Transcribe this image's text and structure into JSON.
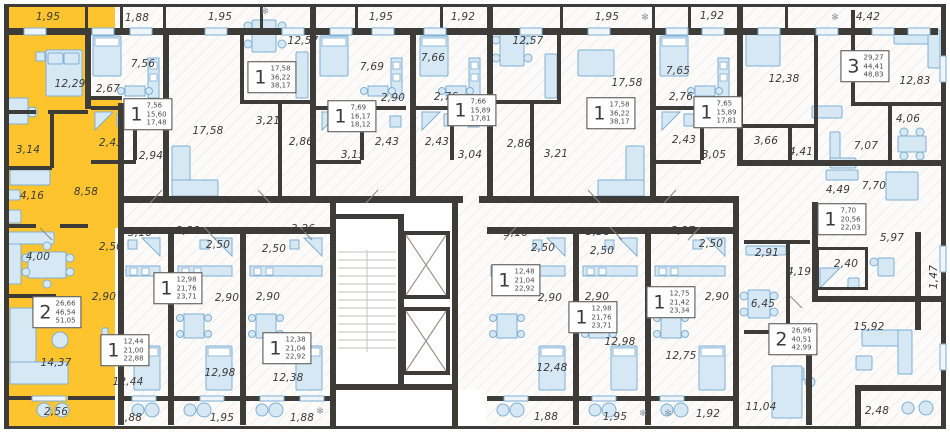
{
  "title": "Residential building floor plan",
  "colors": {
    "highlight": "#fdc42d",
    "wall": "#3e3c39",
    "floor_hatch": "#e8e4df",
    "furniture_fill": "#d7e8f5",
    "furniture_stroke": "#7fafd3",
    "label_text": "#3b3b3b"
  },
  "apartments": [
    {
      "id": "apt-01",
      "type": "2",
      "areas": [
        "26,66",
        "46,54",
        "51,05"
      ],
      "highlighted": true,
      "tag": {
        "x": 57,
        "y": 312
      },
      "rooms": [
        {
          "v": "1,95",
          "x": 48,
          "y": 17
        },
        {
          "v": "12,29",
          "x": 70,
          "y": 84
        },
        {
          "v": "3,14",
          "x": 28,
          "y": 150
        },
        {
          "v": "4,16",
          "x": 32,
          "y": 196
        },
        {
          "v": "8,58",
          "x": 86,
          "y": 192
        },
        {
          "v": "4,00",
          "x": 38,
          "y": 257
        },
        {
          "v": "14,37",
          "x": 56,
          "y": 363
        },
        {
          "v": "2,56",
          "x": 56,
          "y": 412
        }
      ]
    },
    {
      "id": "apt-02",
      "type": "1",
      "areas": [
        "7,56",
        "15,60",
        "17,48"
      ],
      "highlighted": false,
      "tag": {
        "x": 148,
        "y": 114
      },
      "rooms": [
        {
          "v": "1,88",
          "x": 137,
          "y": 18
        },
        {
          "v": "7,56",
          "x": 143,
          "y": 64
        },
        {
          "v": "2,67",
          "x": 108,
          "y": 89
        },
        {
          "v": "2,43",
          "x": 111,
          "y": 143
        },
        {
          "v": "2,94",
          "x": 151,
          "y": 156
        }
      ]
    },
    {
      "id": "apt-03",
      "type": "1",
      "areas": [
        "17,58",
        "36,22",
        "38,17"
      ],
      "highlighted": false,
      "tag": {
        "x": 272,
        "y": 77
      },
      "rooms": [
        {
          "v": "1,95",
          "x": 220,
          "y": 17
        },
        {
          "v": "12,57",
          "x": 303,
          "y": 41
        },
        {
          "v": "17,58",
          "x": 208,
          "y": 131
        },
        {
          "v": "3,21",
          "x": 268,
          "y": 121
        },
        {
          "v": "2,86",
          "x": 301,
          "y": 142
        }
      ]
    },
    {
      "id": "apt-04",
      "type": "1",
      "areas": [
        "7,69",
        "16,17",
        "18,12"
      ],
      "highlighted": false,
      "tag": {
        "x": 352,
        "y": 116
      },
      "rooms": [
        {
          "v": "1,95",
          "x": 381,
          "y": 17
        },
        {
          "v": "7,69",
          "x": 372,
          "y": 67
        },
        {
          "v": "2,90",
          "x": 393,
          "y": 98
        },
        {
          "v": "2,43",
          "x": 387,
          "y": 142
        },
        {
          "v": "3,15",
          "x": 353,
          "y": 155
        }
      ]
    },
    {
      "id": "apt-05",
      "type": "1",
      "areas": [
        "7,66",
        "15,89",
        "17,81"
      ],
      "highlighted": false,
      "tag": {
        "x": 472,
        "y": 110
      },
      "rooms": [
        {
          "v": "1,92",
          "x": 463,
          "y": 17
        },
        {
          "v": "7,66",
          "x": 433,
          "y": 58
        },
        {
          "v": "2,76",
          "x": 446,
          "y": 97
        },
        {
          "v": "2,43",
          "x": 437,
          "y": 142
        },
        {
          "v": "3,04",
          "x": 470,
          "y": 155
        }
      ]
    },
    {
      "id": "apt-06",
      "type": "1",
      "areas": [
        "17,58",
        "36,22",
        "38,17"
      ],
      "highlighted": false,
      "tag": {
        "x": 611,
        "y": 113
      },
      "rooms": [
        {
          "v": "1,95",
          "x": 607,
          "y": 17
        },
        {
          "v": "12,57",
          "x": 528,
          "y": 41
        },
        {
          "v": "17,58",
          "x": 627,
          "y": 83
        },
        {
          "v": "2,86",
          "x": 519,
          "y": 144
        },
        {
          "v": "3,21",
          "x": 556,
          "y": 154
        }
      ]
    },
    {
      "id": "apt-07",
      "type": "1",
      "areas": [
        "7,65",
        "15,89",
        "17,81"
      ],
      "highlighted": false,
      "tag": {
        "x": 718,
        "y": 112
      },
      "rooms": [
        {
          "v": "1,92",
          "x": 712,
          "y": 16
        },
        {
          "v": "7,65",
          "x": 678,
          "y": 71
        },
        {
          "v": "2,76",
          "x": 681,
          "y": 97
        },
        {
          "v": "2,43",
          "x": 684,
          "y": 140
        },
        {
          "v": "3,05",
          "x": 714,
          "y": 155
        }
      ]
    },
    {
      "id": "apt-08",
      "type": "3",
      "areas": [
        "29,27",
        "44,41",
        "48,83"
      ],
      "highlighted": false,
      "tag": {
        "x": 865,
        "y": 66
      },
      "rooms": [
        {
          "v": "4,42",
          "x": 868,
          "y": 17
        },
        {
          "v": "12,38",
          "x": 784,
          "y": 79
        },
        {
          "v": "12,83",
          "x": 915,
          "y": 81
        },
        {
          "v": "4,06",
          "x": 908,
          "y": 119
        },
        {
          "v": "7,07",
          "x": 866,
          "y": 146
        },
        {
          "v": "3,66",
          "x": 766,
          "y": 141
        },
        {
          "v": "4,41",
          "x": 801,
          "y": 152
        }
      ]
    },
    {
      "id": "apt-09",
      "type": "1",
      "areas": [
        "7,70",
        "20,56",
        "22,03"
      ],
      "highlighted": false,
      "tag": {
        "x": 842,
        "y": 219
      },
      "rooms": [
        {
          "v": "4,49",
          "x": 838,
          "y": 190
        },
        {
          "v": "7,70",
          "x": 874,
          "y": 186
        },
        {
          "v": "5,97",
          "x": 892,
          "y": 238
        },
        {
          "v": "2,40",
          "x": 846,
          "y": 264
        },
        {
          "v": "1,47",
          "x": 934,
          "y": 277,
          "rot": true
        }
      ]
    },
    {
      "id": "apt-10",
      "type": "2",
      "areas": [
        "26,96",
        "40,51",
        "42,99"
      ],
      "highlighted": false,
      "tag": {
        "x": 793,
        "y": 339
      },
      "rooms": [
        {
          "v": "2,91",
          "x": 767,
          "y": 253
        },
        {
          "v": "4,19",
          "x": 799,
          "y": 272
        },
        {
          "v": "6,45",
          "x": 763,
          "y": 304
        },
        {
          "v": "15,92",
          "x": 869,
          "y": 327
        },
        {
          "v": "11,04",
          "x": 761,
          "y": 407
        },
        {
          "v": "2,48",
          "x": 877,
          "y": 411
        }
      ]
    },
    {
      "id": "apt-11",
      "type": "1",
      "areas": [
        "12,44",
        "21,00",
        "22,88"
      ],
      "highlighted": false,
      "tag": {
        "x": 125,
        "y": 350
      },
      "rooms": [
        {
          "v": "3,16",
          "x": 140,
          "y": 233
        },
        {
          "v": "2,50",
          "x": 111,
          "y": 247
        },
        {
          "v": "2,90",
          "x": 104,
          "y": 297
        },
        {
          "v": "12,44",
          "x": 128,
          "y": 382
        },
        {
          "v": "1,88",
          "x": 130,
          "y": 418
        }
      ]
    },
    {
      "id": "apt-12",
      "type": "1",
      "areas": [
        "12,98",
        "21,76",
        "23,71"
      ],
      "highlighted": false,
      "tag": {
        "x": 178,
        "y": 288
      },
      "rooms": [
        {
          "v": "3,38",
          "x": 188,
          "y": 231
        },
        {
          "v": "2,50",
          "x": 218,
          "y": 245
        },
        {
          "v": "2,90",
          "x": 227,
          "y": 298
        },
        {
          "v": "12,98",
          "x": 220,
          "y": 373
        },
        {
          "v": "1,95",
          "x": 222,
          "y": 418
        }
      ]
    },
    {
      "id": "apt-13",
      "type": "1",
      "areas": [
        "12,38",
        "21,04",
        "22,92"
      ],
      "highlighted": false,
      "tag": {
        "x": 287,
        "y": 348
      },
      "rooms": [
        {
          "v": "3,26",
          "x": 303,
          "y": 229
        },
        {
          "v": "2,50",
          "x": 274,
          "y": 249
        },
        {
          "v": "2,90",
          "x": 268,
          "y": 297
        },
        {
          "v": "12,38",
          "x": 288,
          "y": 378
        },
        {
          "v": "1,88",
          "x": 302,
          "y": 418
        }
      ]
    },
    {
      "id": "apt-14",
      "type": "1",
      "areas": [
        "12,48",
        "21,04",
        "22,92"
      ],
      "highlighted": false,
      "tag": {
        "x": 516,
        "y": 280
      },
      "rooms": [
        {
          "v": "3,16",
          "x": 516,
          "y": 233
        },
        {
          "v": "2,50",
          "x": 543,
          "y": 248
        },
        {
          "v": "2,90",
          "x": 550,
          "y": 298
        },
        {
          "v": "12,48",
          "x": 552,
          "y": 368
        },
        {
          "v": "1,88",
          "x": 546,
          "y": 417
        }
      ]
    },
    {
      "id": "apt-15",
      "type": "1",
      "areas": [
        "12,98",
        "21,76",
        "23,71"
      ],
      "highlighted": false,
      "tag": {
        "x": 593,
        "y": 317
      },
      "rooms": [
        {
          "v": "3,38",
          "x": 598,
          "y": 232
        },
        {
          "v": "2,50",
          "x": 602,
          "y": 251
        },
        {
          "v": "2,90",
          "x": 597,
          "y": 297
        },
        {
          "v": "12,98",
          "x": 620,
          "y": 342
        },
        {
          "v": "1,95",
          "x": 615,
          "y": 417
        }
      ]
    },
    {
      "id": "apt-16",
      "type": "1",
      "areas": [
        "12,75",
        "21,42",
        "23,34"
      ],
      "highlighted": false,
      "tag": {
        "x": 671,
        "y": 302
      },
      "rooms": [
        {
          "v": "3,27",
          "x": 683,
          "y": 231
        },
        {
          "v": "2,50",
          "x": 711,
          "y": 244
        },
        {
          "v": "2,90",
          "x": 717,
          "y": 297
        },
        {
          "v": "12,75",
          "x": 681,
          "y": 356
        },
        {
          "v": "1,92",
          "x": 708,
          "y": 414
        }
      ]
    }
  ],
  "decor_icons": [
    {
      "glyph": "✻",
      "x": 265,
      "y": 12
    },
    {
      "glyph": "✻",
      "x": 645,
      "y": 18
    },
    {
      "glyph": "✻",
      "x": 835,
      "y": 18
    },
    {
      "glyph": "✻",
      "x": 320,
      "y": 412
    },
    {
      "glyph": "✻",
      "x": 643,
      "y": 414
    },
    {
      "glyph": "✻",
      "x": 668,
      "y": 414
    }
  ]
}
